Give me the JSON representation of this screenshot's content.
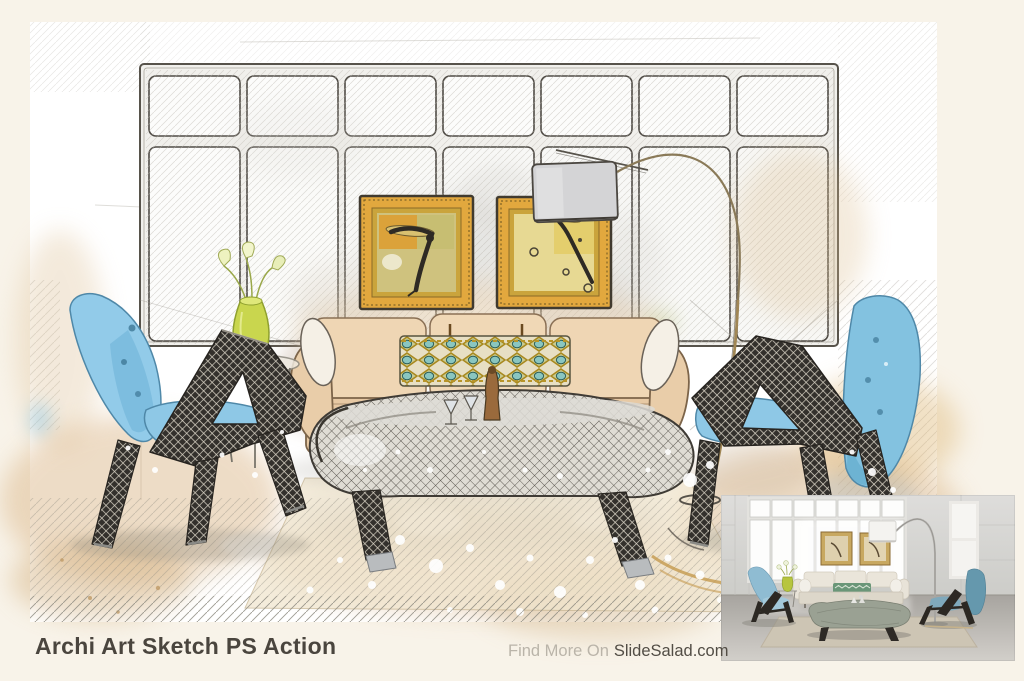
{
  "footer": {
    "title": "Archi Art Sketch PS Action",
    "find_more_prefix": "Find More On",
    "brand": "SlideSalad.com"
  },
  "scene": {
    "style": "watercolor and pencil sketch photo effect on white paper",
    "subject": "mid-century living room: window wall with transom panes, two gold framed artworks, arc floor lamp, cream sofa with patterned lumbar pillow, two blue lounge chairs with dark lattice wood frames, curved tufted bench with cocktail glasses, lime vase with calla lilies, tan watercolor floor washes and white paint splatters",
    "inset_label": "original photo preview (bottom-right corner)",
    "palette": {
      "page_background": "#f8f3e9",
      "paper": "#ffffff",
      "title_text": "#4a453e",
      "muted_text": "#bab4a9",
      "chair_blue": "#8ec8e6",
      "chair_teal": "#6598ad",
      "wood_lattice_dark": "#33302c",
      "wash_tan": "#d9b282",
      "frame_gold": "#e2a83e",
      "vase_lime": "#c9d64e",
      "pillow_teal": "#8ac6c0",
      "photo_floor_gray": "#b3b0ab"
    }
  }
}
